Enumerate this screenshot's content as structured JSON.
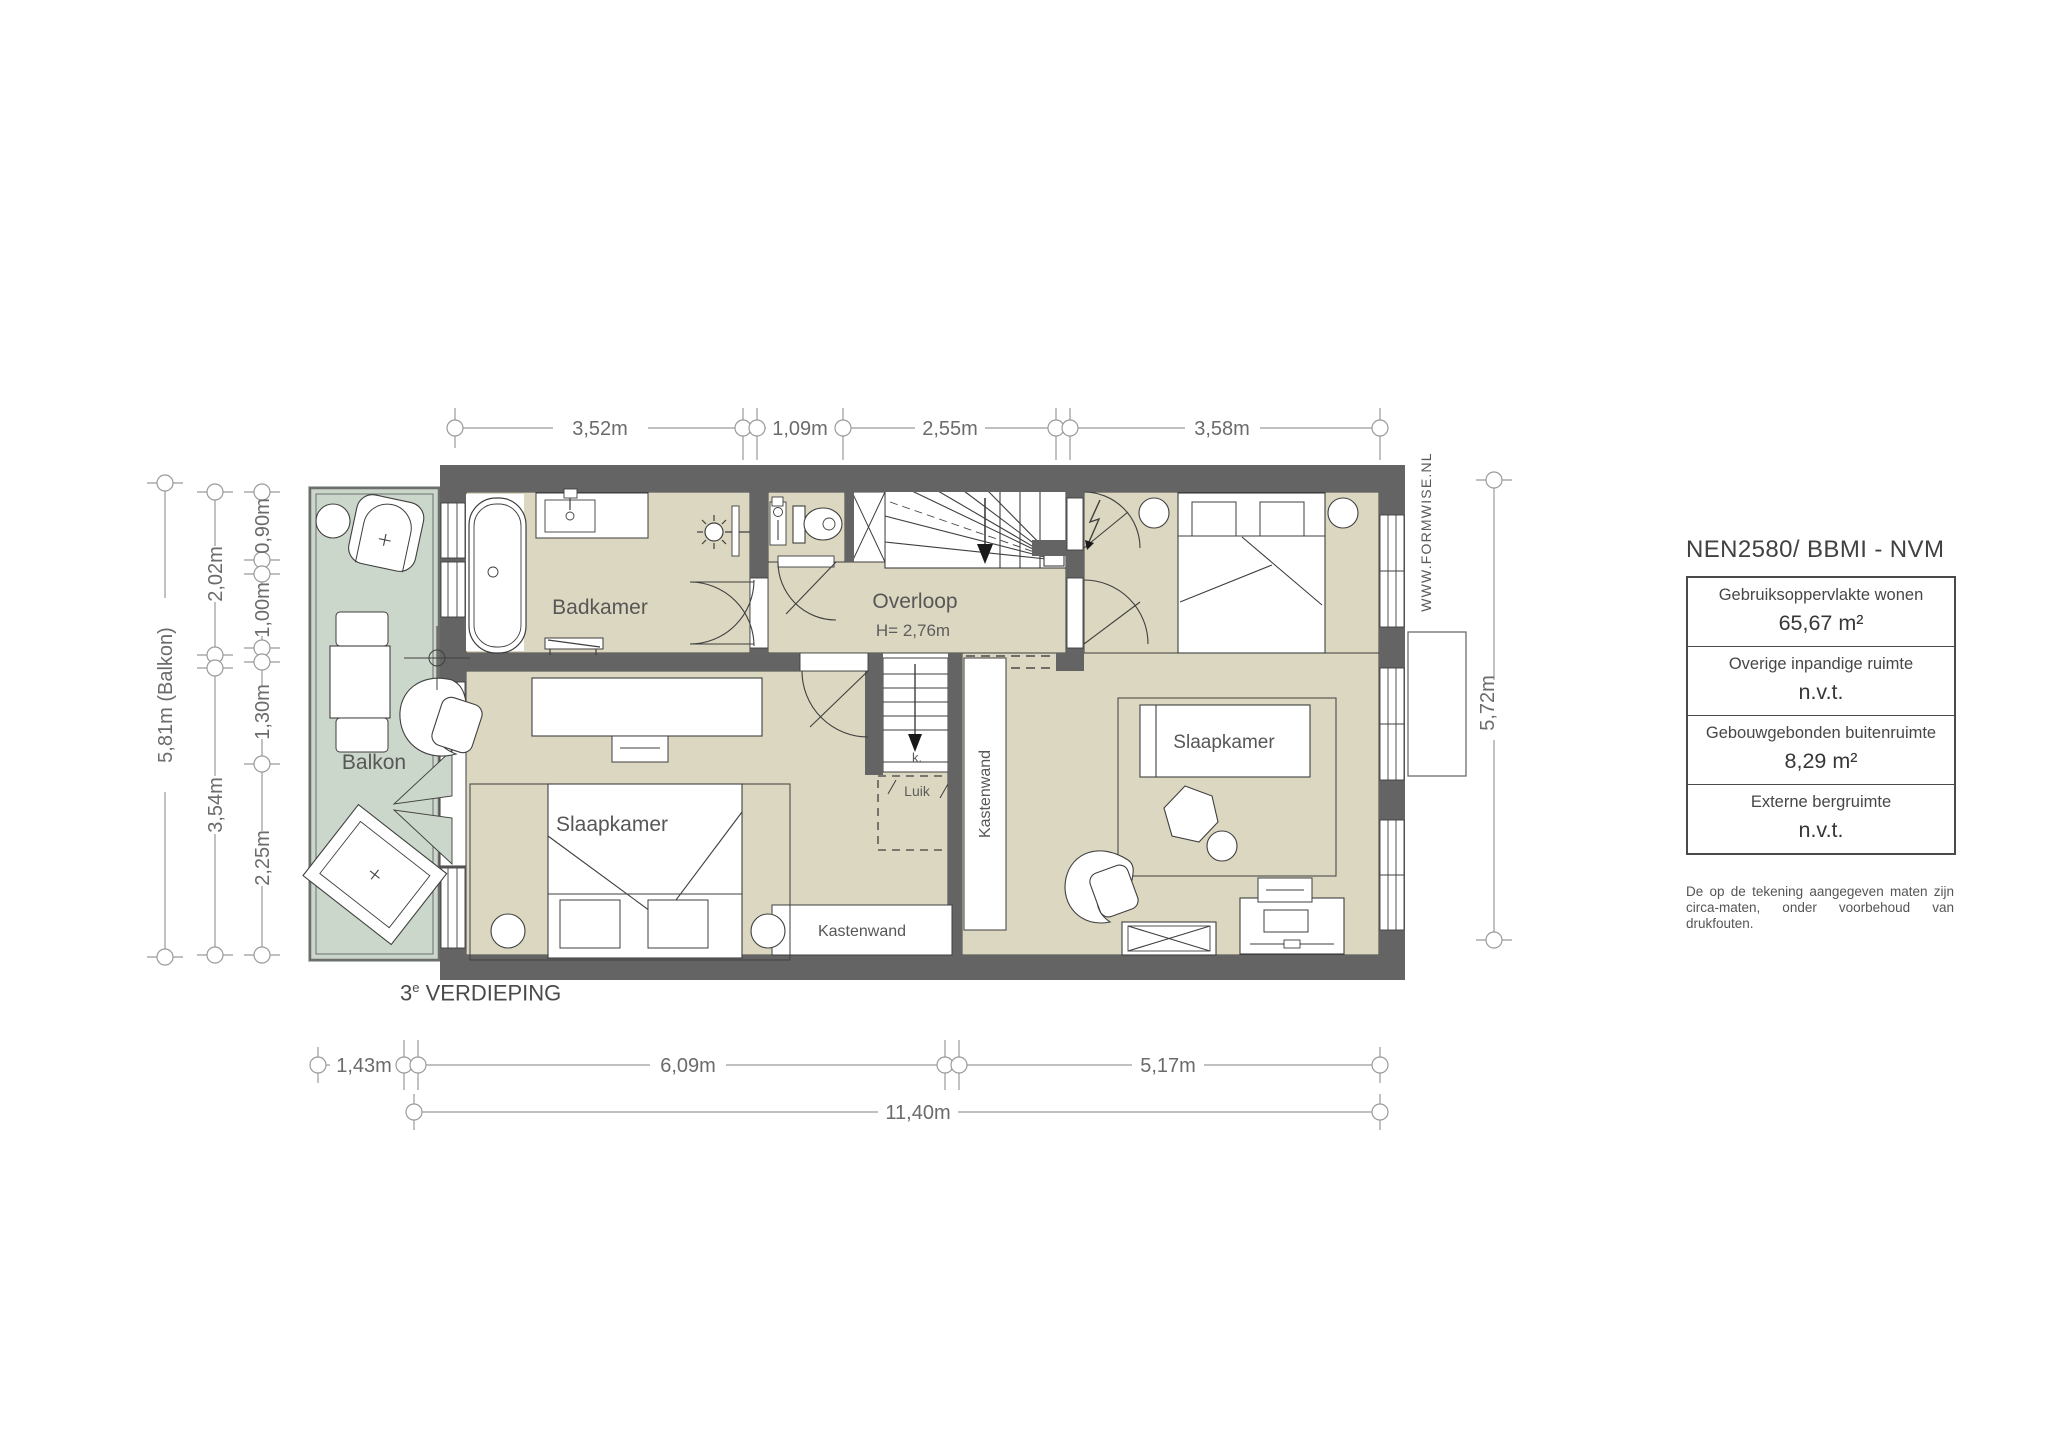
{
  "plan": {
    "floor_caption": {
      "num": "3",
      "sup": "e",
      "rest": " VERDIEPING"
    },
    "rooms": {
      "badkamer": "Badkamer",
      "overloop": "Overloop",
      "overloop_height": "H= 2,76m",
      "slaapkamer_left": "Slaapkamer",
      "slaapkamer_right": "Slaapkamer",
      "balkon": "Balkon",
      "kastenwand_vertical": "Kastenwand",
      "kastenwand_horizontal": "Kastenwand",
      "luik": "Luik",
      "closet_k": "k."
    },
    "dimensions": {
      "top": [
        "3,52m",
        "1,09m",
        "2,55m",
        "3,58m"
      ],
      "left_inner": [
        "0,90m",
        "1,00m",
        "1,30m",
        "2,25m"
      ],
      "left_mid": [
        "2,02m",
        "3,54m"
      ],
      "left_outer": "5,81m (Balkon)",
      "right": "5,72m",
      "bottom": [
        "1,43m",
        "6,09m",
        "5,17m"
      ],
      "bottom_total": "11,40m"
    },
    "watermark": "WWW.FORMWISE.NL",
    "colors": {
      "wall": "#646464",
      "room": "#dbd7c0",
      "balcony": "#cbd7ca"
    }
  },
  "panel": {
    "title": "NEN2580/ BBMI - NVM",
    "rows": [
      {
        "label": "Gebruiksoppervlakte wonen",
        "value": "65,67 m²"
      },
      {
        "label": "Overige inpandige ruimte",
        "value": "n.v.t."
      },
      {
        "label": "Gebouwgebonden buitenruimte",
        "value": "8,29 m²"
      },
      {
        "label": "Externe bergruimte",
        "value": "n.v.t."
      }
    ],
    "disclaimer": "De op de tekening aangegeven maten zijn circa-maten, onder voorbehoud van drukfouten."
  }
}
